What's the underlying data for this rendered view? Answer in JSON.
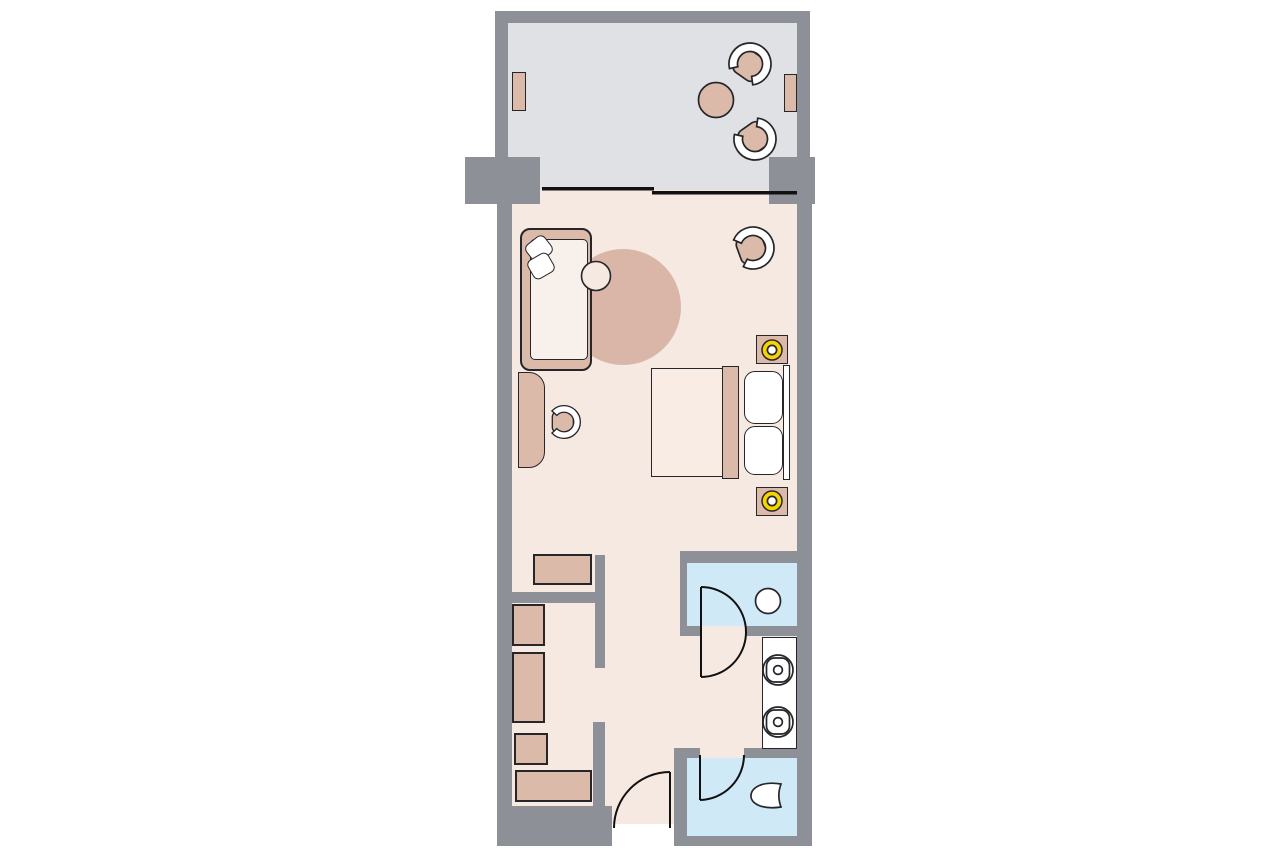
{
  "meta": {
    "title": "Hotel guest room floor plan",
    "diagram_type": "architectural-floor-plan",
    "visible_text": []
  },
  "palette": {
    "background": "#ffffff",
    "wall": "#8d9096",
    "balcony_floor": "#e0e1e5",
    "room_floor": "#f5e9e2",
    "wet_room_floor": "#cfe9f6",
    "furniture_tan": "#dcbaa9",
    "rug": "#d9b6a7",
    "bedding": "#f8ece5",
    "seat_cream": "#f8f1eb",
    "white": "#ffffff",
    "lamp_yellow": "#f6d400",
    "outline": "#26262a",
    "door_line": "#111111"
  },
  "rooms": [
    {
      "id": "balcony",
      "floor": "balcony_floor"
    },
    {
      "id": "living-bedroom",
      "floor": "room_floor"
    },
    {
      "id": "dressing-area",
      "floor": "room_floor"
    },
    {
      "id": "hallway-entry",
      "floor": "room_floor"
    },
    {
      "id": "shower-room",
      "floor": "wet_room_floor"
    },
    {
      "id": "wc-room",
      "floor": "wet_room_floor"
    }
  ],
  "furniture": {
    "balcony": [
      "lounge-chair",
      "lounge-chair",
      "round-table",
      "planter",
      "planter"
    ],
    "living_bedroom": [
      "sofa",
      "pillow",
      "pillow",
      "round-rug",
      "side-table",
      "armchair",
      "desk",
      "desk-chair",
      "double-bed",
      "pillow",
      "pillow",
      "headboard",
      "nightstand-with-lamp",
      "nightstand-with-lamp"
    ],
    "dressing_area": [
      "shelf",
      "wardrobe",
      "wardrobe",
      "wardrobe",
      "bench"
    ],
    "shower_room": [
      "stool"
    ],
    "bathroom": [
      "vanity-double-sink",
      "sink",
      "sink"
    ],
    "wc_room": [
      "toilet"
    ],
    "doors": [
      "sliding-balcony-door",
      "shower-swing-door",
      "wc-door",
      "entry-door"
    ]
  },
  "lamp_count": 2,
  "sink_count": 2
}
